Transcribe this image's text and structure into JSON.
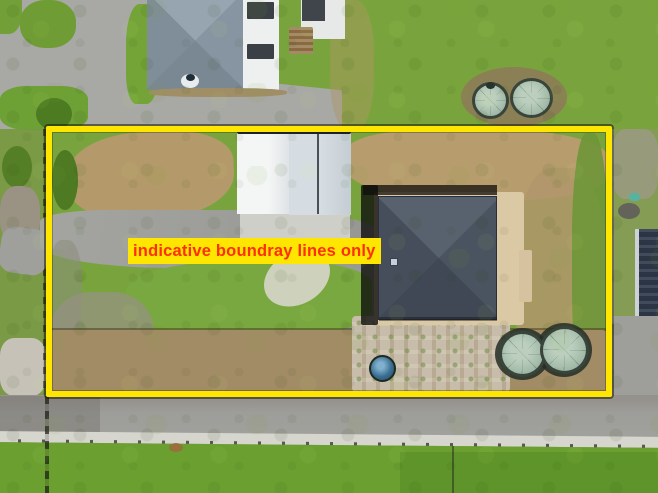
{
  "image": {
    "type": "aerial-photograph",
    "width": 658,
    "height": 493,
    "description": "Top-down drone photo of a rural property with an indicative boundary marked in yellow"
  },
  "annotation": {
    "label": "indicative boundray lines only"
  },
  "boundary": {
    "shape": "rectangle",
    "color": "#ffe600",
    "outline_color": "#1c1906"
  },
  "scene": {
    "objects": [
      "neighbouring house with solar panels",
      "picnic table",
      "two water tanks outside north boundary",
      "garden shed with twin gable roof",
      "main house with dark hip roof and timber deck",
      "skylight",
      "two water tanks inside south-east corner",
      "small round plunge pool",
      "internal gravel driveway",
      "dry grass patches",
      "paver patio with plantings",
      "rock piles along west side",
      "dark outbuilding east of boundary",
      "sealed road along south boundary",
      "white gravel shoulder with fence posts",
      "grass verge"
    ]
  },
  "palette": {
    "boundary-yellow": "#ffe600",
    "label-red": "#ff2d00",
    "grass-green": "#79a43d",
    "grass-dark": "#4c7b22",
    "dry-grass": "#b49a6a",
    "road-gray": "#9d9d99",
    "driveway-gray": "#a8a8a4",
    "roof-dark": "#49525e",
    "roof-light": "#8c9aa6",
    "shed-white": "#eef0f0",
    "shed-gray": "#ccd4da",
    "tank-green": "#a6bdac",
    "deck-tan": "#dbc8a5",
    "gravel-tan": "#a28c66",
    "paver-light": "#c2b69e",
    "pool-blue": "#2f5d7e",
    "shoulder-white": "#d6d5ce"
  }
}
